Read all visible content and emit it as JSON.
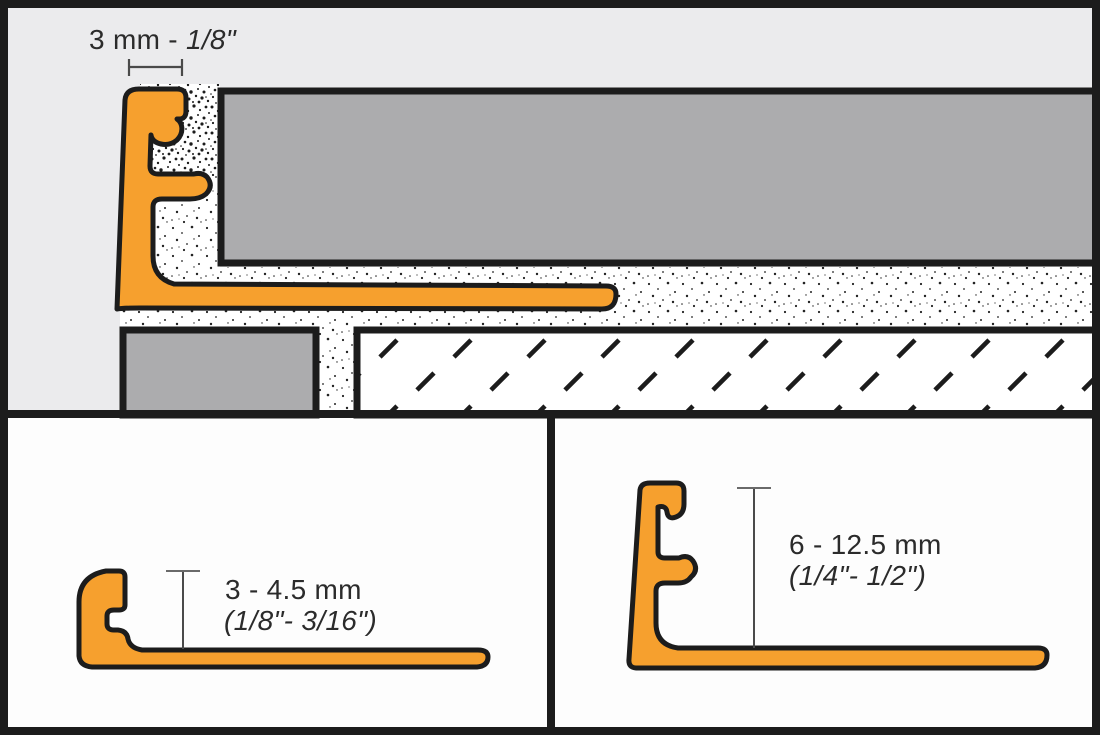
{
  "diagram_title": "tile-edge-profile-installation-diagram",
  "panels": {
    "installation": {
      "edge_width_label_metric": "3 mm - ",
      "edge_width_label_imperial": "1/8\""
    },
    "variant_small": {
      "height_label_metric": "3 - 4.5 mm",
      "height_label_imperial": "(1/8\"- 3/16\")"
    },
    "variant_large": {
      "height_label_metric": "6 - 12.5 mm",
      "height_label_imperial": "(1/4\"- 1/2\")"
    }
  },
  "colors": {
    "profile_orange": "#F6A02E",
    "tile_gray": "#ACACAE",
    "background_gray": "#EBEBED",
    "panel_white": "#FDFDFD",
    "outline_black": "#1C1C1C",
    "dimension_line": "#4A4A4A",
    "text": "#2B2B2B"
  }
}
